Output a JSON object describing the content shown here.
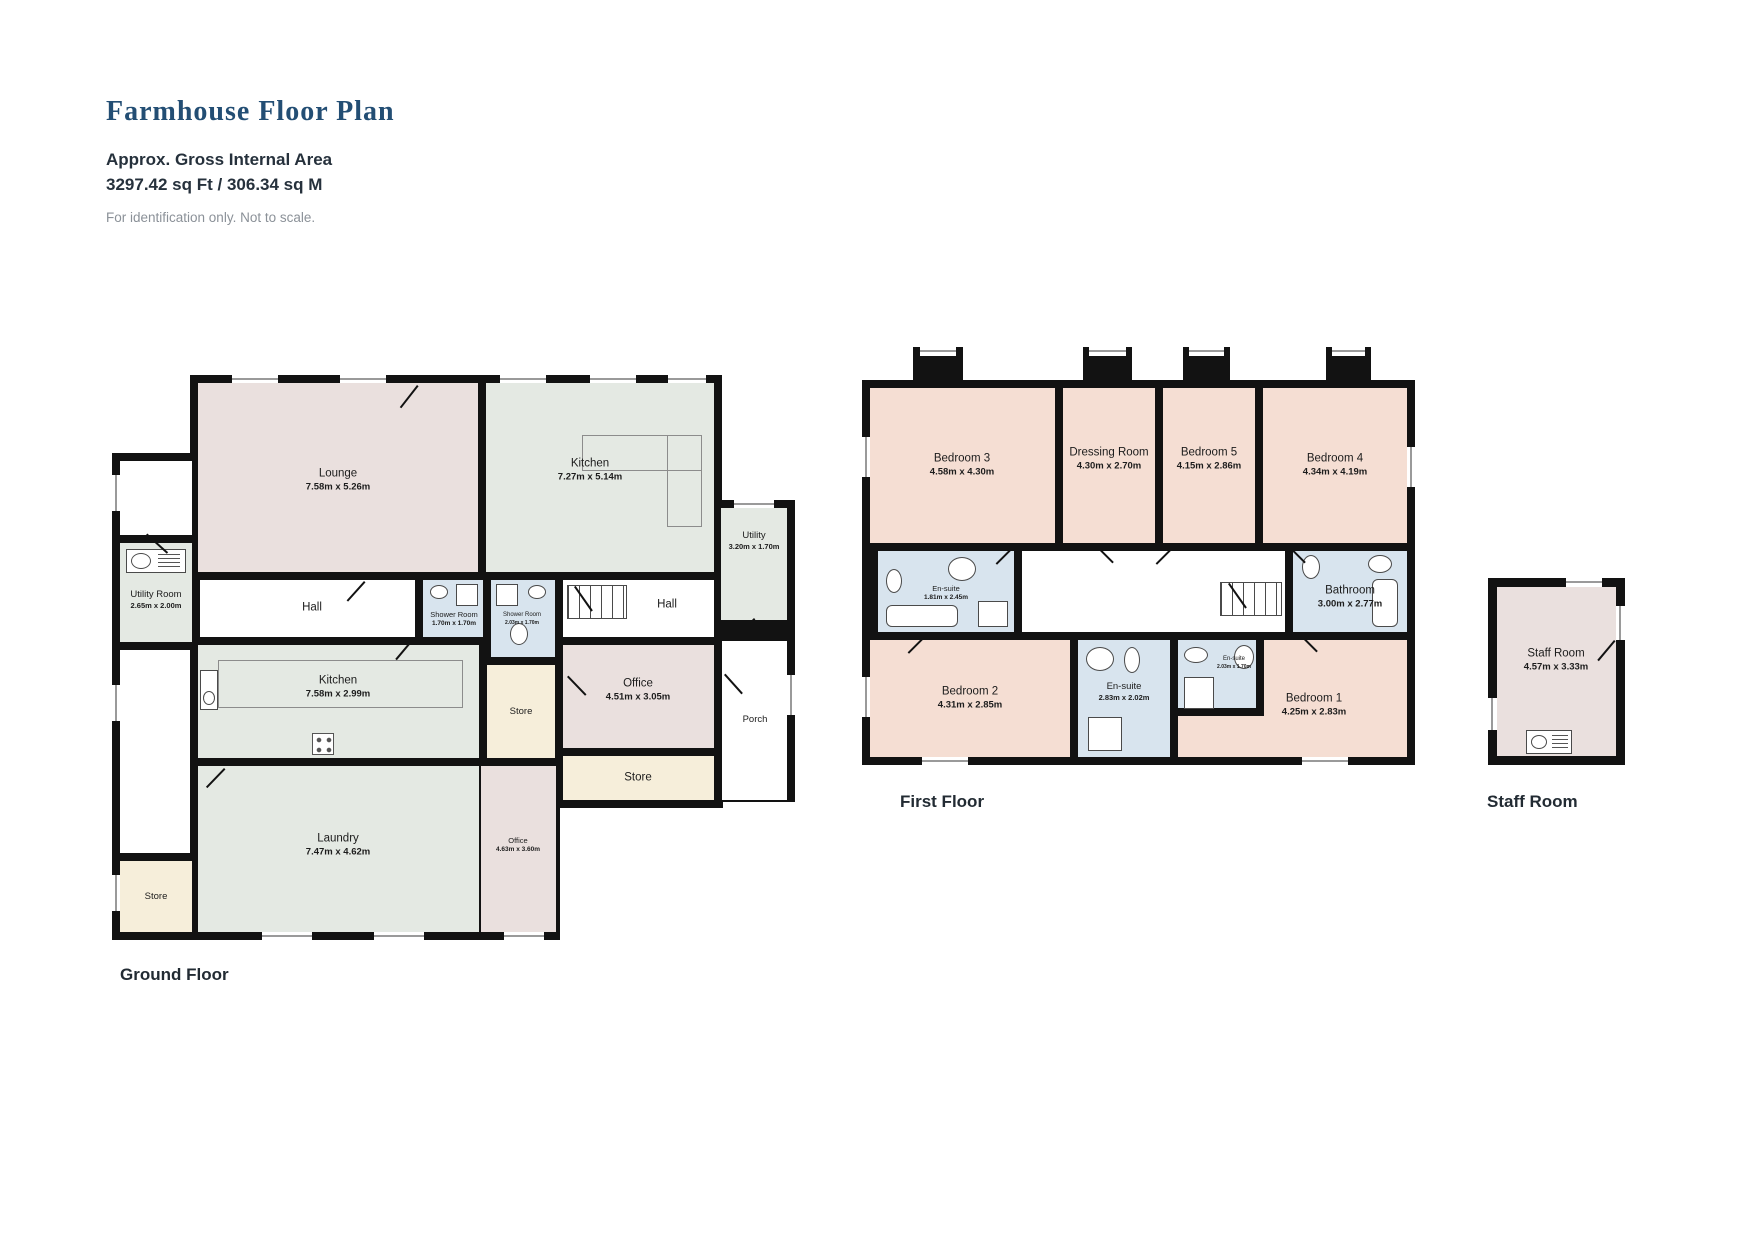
{
  "header": {
    "title": "Farmhouse Floor Plan",
    "area_heading": "Approx. Gross Internal Area",
    "area_value": "3297.42 sq Ft / 306.34 sq M",
    "disclaimer": "For identification only. Not to scale."
  },
  "palette": {
    "wall": "#121212",
    "room_pink": "#f5ded3",
    "room_neutral": "#eae0de",
    "room_sage": "#e4e9e3",
    "room_blue": "#d8e4ee",
    "room_cream": "#f6eeda",
    "title_navy": "#234e74"
  },
  "ground_floor": {
    "label": "Ground Floor",
    "rooms": {
      "lounge": {
        "name": "Lounge",
        "dims": "7.58m x 5.26m"
      },
      "kitchen": {
        "name": "Kitchen",
        "dims": "7.27m x 5.14m"
      },
      "utility_room": {
        "name": "Utility Room",
        "dims": "2.65m x 2.00m"
      },
      "utility": {
        "name": "Utility",
        "dims": "3.20m x 1.70m"
      },
      "hall_front": {
        "name": "Hall"
      },
      "shower_room_1": {
        "name": "Shower Room",
        "dims": "1.70m x 1.70m"
      },
      "shower_room_2": {
        "name": "Shower Room",
        "dims": "2.03m x 1.70m"
      },
      "hall_rear": {
        "name": "Hall"
      },
      "kitchen_2": {
        "name": "Kitchen",
        "dims": "7.58m x 2.99m"
      },
      "store_mid": {
        "name": "Store"
      },
      "office_1": {
        "name": "Office",
        "dims": "4.51m x 3.05m"
      },
      "store_right": {
        "name": "Store"
      },
      "porch": {
        "name": "Porch"
      },
      "laundry": {
        "name": "Laundry",
        "dims": "7.47m x 4.62m"
      },
      "office_2": {
        "name": "Office",
        "dims": "4.63m x 3.60m"
      },
      "store_left": {
        "name": "Store"
      }
    }
  },
  "first_floor": {
    "label": "First Floor",
    "rooms": {
      "bedroom_3": {
        "name": "Bedroom 3",
        "dims": "4.58m x 4.30m"
      },
      "dressing_room": {
        "name": "Dressing Room",
        "dims": "4.30m x 2.70m"
      },
      "bedroom_5": {
        "name": "Bedroom 5",
        "dims": "4.15m x 2.86m"
      },
      "bedroom_4": {
        "name": "Bedroom 4",
        "dims": "4.34m x 4.19m"
      },
      "en_suite_1": {
        "name": "En-suite",
        "dims": "1.81m x 2.45m"
      },
      "bathroom": {
        "name": "Bathroom",
        "dims": "3.00m x 2.77m"
      },
      "bedroom_2": {
        "name": "Bedroom 2",
        "dims": "4.31m x 2.85m"
      },
      "en_suite_2": {
        "name": "En-suite",
        "dims": "2.83m x 2.02m"
      },
      "en_suite_3": {
        "name": "En-suite",
        "dims": "2.03m x 1.70m"
      },
      "bedroom_1": {
        "name": "Bedroom 1",
        "dims": "4.25m x 2.83m"
      }
    }
  },
  "staff_floor": {
    "label": "Staff Room",
    "room": {
      "name": "Staff Room",
      "dims": "4.57m x 3.33m"
    }
  }
}
